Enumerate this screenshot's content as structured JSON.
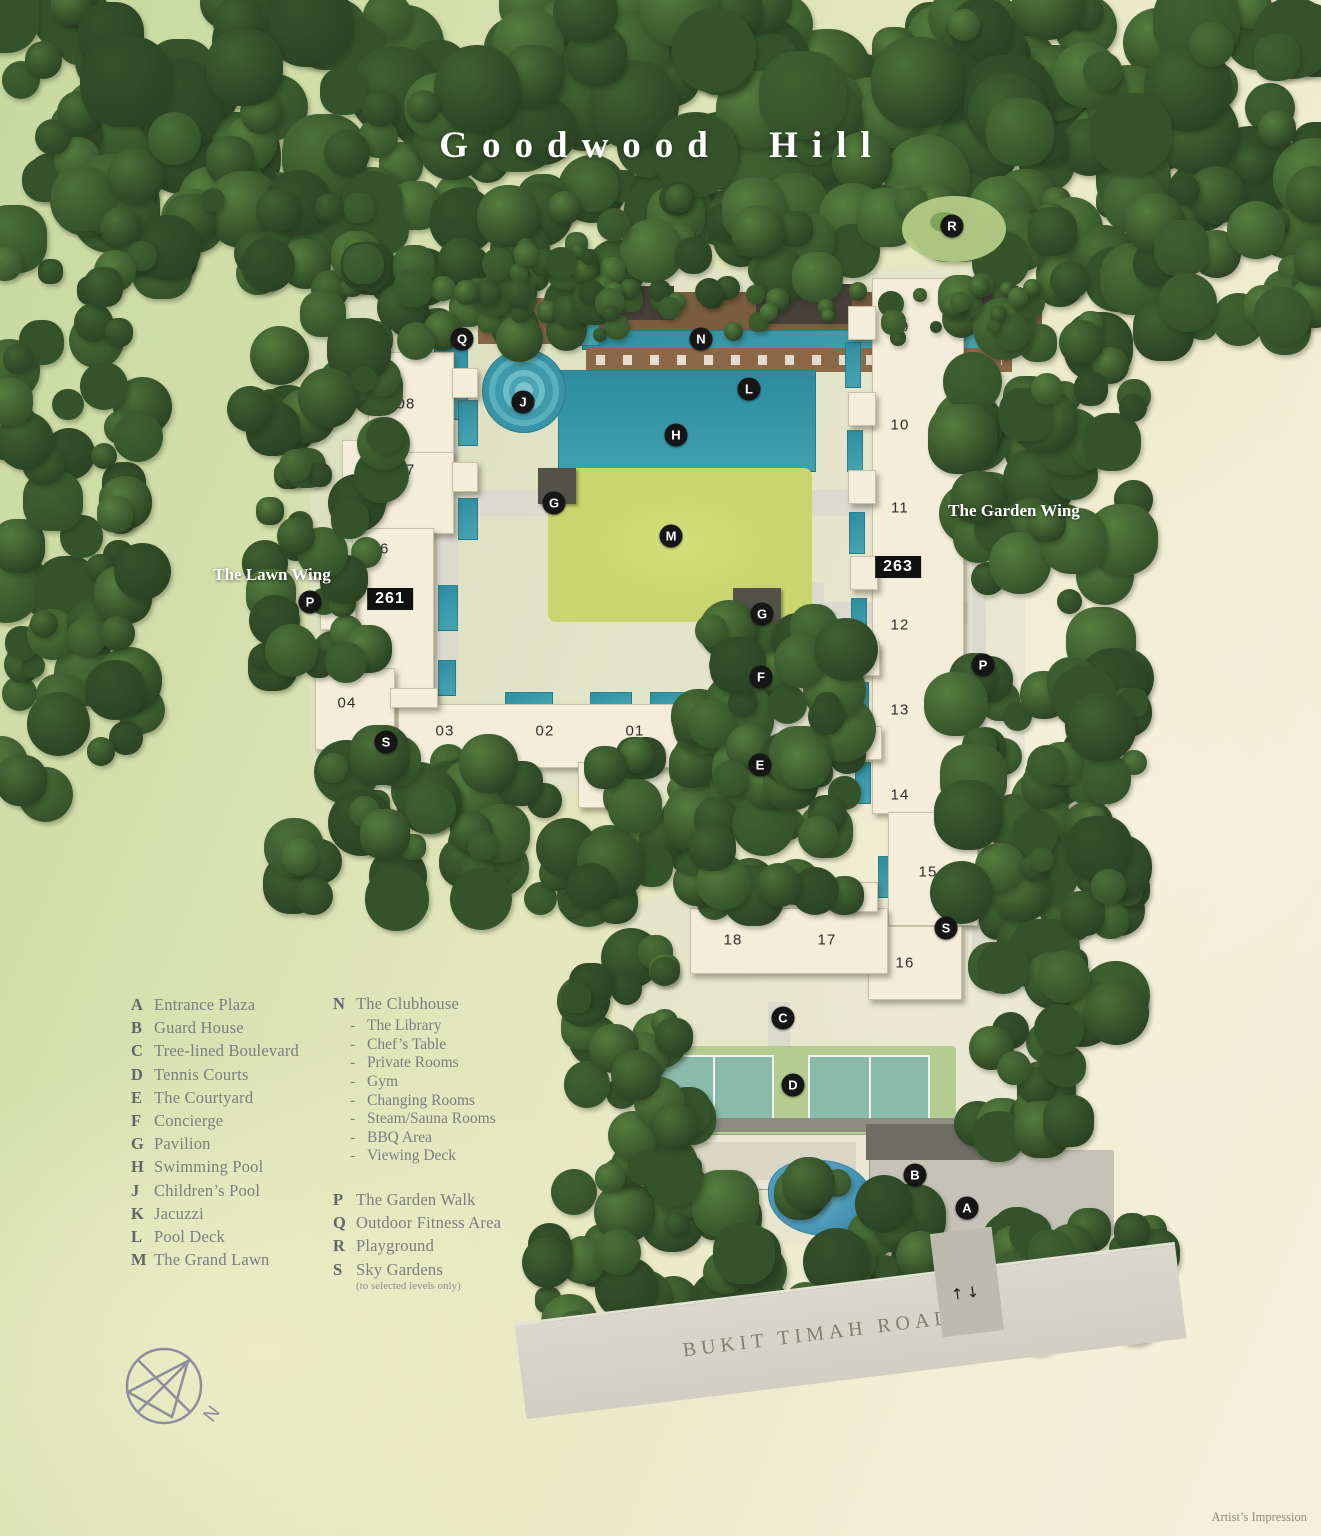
{
  "title": "Goodwood Hill",
  "attribution": "Artist’s Impression",
  "road": {
    "name": "BUKIT TIMAH ROAD"
  },
  "entrance_arrows": "↑↓",
  "compass": {
    "label": "N"
  },
  "colors": {
    "marker_bg": "#161616",
    "building_fill": "#f3edd9",
    "pool": "#3796a7",
    "lawn": "#c9d66f",
    "tennis_court": "#8abaaa",
    "tree_dark": "#35532b",
    "road_gray": "#d5d3c7"
  },
  "wings": [
    {
      "name": "The Lawn Wing",
      "x": 272,
      "y": 575
    },
    {
      "name": "The Garden Wing",
      "x": 1014,
      "y": 511
    }
  ],
  "unit_badges": [
    {
      "number": "261",
      "x": 390,
      "y": 599
    },
    {
      "number": "263",
      "x": 898,
      "y": 567
    }
  ],
  "buildings": [
    {
      "number": "01",
      "x": 635,
      "y": 731
    },
    {
      "number": "02",
      "x": 545,
      "y": 731
    },
    {
      "number": "03",
      "x": 445,
      "y": 731
    },
    {
      "number": "04",
      "x": 347,
      "y": 703
    },
    {
      "number": "05",
      "x": 380,
      "y": 647
    },
    {
      "number": "06",
      "x": 380,
      "y": 549
    },
    {
      "number": "07",
      "x": 406,
      "y": 470
    },
    {
      "number": "08",
      "x": 406,
      "y": 404
    },
    {
      "number": "09",
      "x": 900,
      "y": 327
    },
    {
      "number": "10",
      "x": 900,
      "y": 425
    },
    {
      "number": "11",
      "x": 900,
      "y": 508
    },
    {
      "number": "12",
      "x": 900,
      "y": 625
    },
    {
      "number": "13",
      "x": 900,
      "y": 710
    },
    {
      "number": "14",
      "x": 900,
      "y": 795
    },
    {
      "number": "15",
      "x": 928,
      "y": 872
    },
    {
      "number": "16",
      "x": 905,
      "y": 963
    },
    {
      "number": "17",
      "x": 827,
      "y": 940
    },
    {
      "number": "18",
      "x": 733,
      "y": 940
    }
  ],
  "markers": [
    {
      "letter": "A",
      "name": "Entrance Plaza",
      "x": 967,
      "y": 1208
    },
    {
      "letter": "B",
      "name": "Guard House",
      "x": 915,
      "y": 1175
    },
    {
      "letter": "C",
      "name": "Tree-lined Boulevard",
      "x": 783,
      "y": 1018
    },
    {
      "letter": "D",
      "name": "Tennis Courts",
      "x": 793,
      "y": 1085
    },
    {
      "letter": "E",
      "name": "The Courtyard",
      "x": 760,
      "y": 765
    },
    {
      "letter": "F",
      "name": "Concierge",
      "x": 761,
      "y": 677
    },
    {
      "letter": "G",
      "name": "Pavilion",
      "x": 554,
      "y": 503
    },
    {
      "letter": "G",
      "name": "Pavilion",
      "x": 762,
      "y": 614
    },
    {
      "letter": "H",
      "name": "Swimming Pool",
      "x": 676,
      "y": 435
    },
    {
      "letter": "J",
      "name": "Children’s Pool",
      "x": 523,
      "y": 402
    },
    {
      "letter": "L",
      "name": "Pool Deck",
      "x": 749,
      "y": 389
    },
    {
      "letter": "M",
      "name": "The Grand Lawn",
      "x": 671,
      "y": 536
    },
    {
      "letter": "N",
      "name": "The Clubhouse",
      "x": 701,
      "y": 339
    },
    {
      "letter": "P",
      "name": "The Garden Walk",
      "x": 310,
      "y": 602
    },
    {
      "letter": "P",
      "name": "The Garden Walk",
      "x": 983,
      "y": 665
    },
    {
      "letter": "Q",
      "name": "Outdoor Fitness Area",
      "x": 462,
      "y": 339
    },
    {
      "letter": "R",
      "name": "Playground",
      "x": 952,
      "y": 226
    },
    {
      "letter": "S",
      "name": "Sky Gardens",
      "x": 386,
      "y": 742
    },
    {
      "letter": "S",
      "name": "Sky Gardens",
      "x": 946,
      "y": 928
    }
  ],
  "legend": {
    "items_left": [
      {
        "key": "A",
        "label": "Entrance Plaza"
      },
      {
        "key": "B",
        "label": "Guard House"
      },
      {
        "key": "C",
        "label": "Tree-lined Boulevard"
      },
      {
        "key": "D",
        "label": "Tennis Courts"
      },
      {
        "key": "E",
        "label": "The Courtyard"
      },
      {
        "key": "F",
        "label": "Concierge"
      },
      {
        "key": "G",
        "label": "Pavilion"
      },
      {
        "key": "H",
        "label": "Swimming Pool"
      },
      {
        "key": "J",
        "label": "Children’s Pool"
      },
      {
        "key": "K",
        "label": "Jacuzzi"
      },
      {
        "key": "L",
        "label": "Pool Deck"
      },
      {
        "key": "M",
        "label": "The Grand Lawn"
      }
    ],
    "clubhouse": {
      "key": "N",
      "label": "The Clubhouse",
      "sub_items": [
        "The Library",
        "Chef’s Table",
        "Private Rooms",
        "Gym",
        "Changing Rooms",
        "Steam/Sauna Rooms",
        "BBQ Area",
        "Viewing Deck"
      ]
    },
    "items_right": [
      {
        "key": "P",
        "label": "The Garden Walk"
      },
      {
        "key": "Q",
        "label": "Outdoor Fitness Area"
      },
      {
        "key": "R",
        "label": "Playground"
      },
      {
        "key": "S",
        "label": "Sky Gardens",
        "note": "(to selected levels only)"
      }
    ]
  }
}
